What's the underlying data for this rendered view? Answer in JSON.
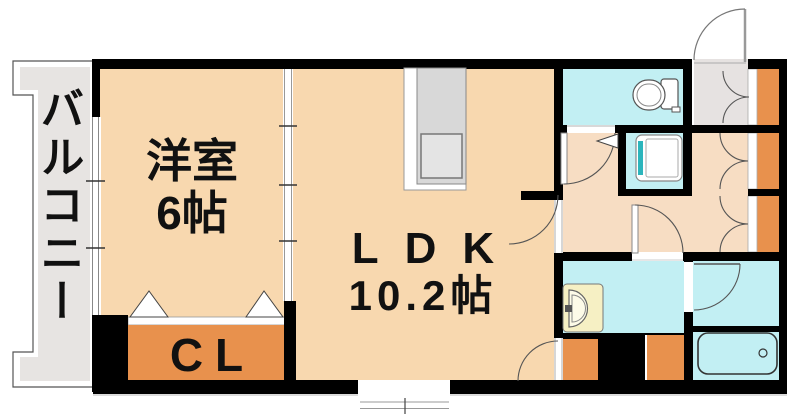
{
  "rooms": {
    "balcony": {
      "label": "バルコニー"
    },
    "western_room": {
      "label": "洋室",
      "size": "6帖"
    },
    "ldk": {
      "label": "LDK",
      "size": "10.2帖"
    },
    "closet": {
      "label": "CL"
    }
  },
  "fixtures": {
    "kitchen_counter": "kitchen-counter",
    "sink": "kitchen-sink",
    "toilet": "toilet",
    "washing_machine": "washing-machine",
    "washbasin": "washbasin",
    "bathtub": "bathtub",
    "shoe_cabinet": "shoe-cabinet",
    "hall_closets": "hall-closet",
    "entry_door": "entry-door"
  },
  "colors": {
    "room": "#f8d8af",
    "hall": "#f7ddc3",
    "closet_orange": "#e8914d",
    "water_cyan": "#c2eff3",
    "genkan_gray": "#e6e2e1",
    "balcony_gray": "#e7e4e2",
    "counter_gray": "#d8d8d8",
    "washer_teal": "#2cb5bc",
    "basin_cream": "#f6f0c4",
    "wall": "#000000"
  }
}
